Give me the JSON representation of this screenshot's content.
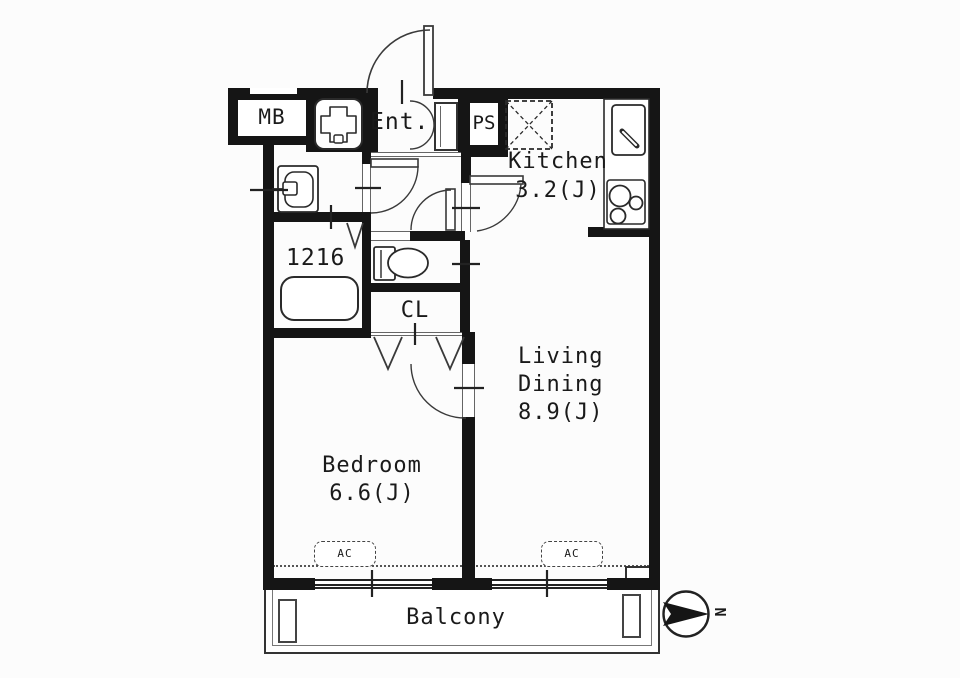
{
  "plan": {
    "meter_box_label": "MB",
    "entrance_label": "Ent.",
    "pipe_space_label": "PS",
    "kitchen_name": "Kitchen",
    "kitchen_size": "3.2(J)",
    "bath_size_label": "1216",
    "closet_label": "CL",
    "living_name_line1": "Living",
    "living_name_line2": "Dining",
    "living_size": "8.9(J)",
    "bedroom_name": "Bedroom",
    "bedroom_size": "6.6(J)",
    "ac_label": "AC",
    "balcony_label": "Balcony",
    "north_label": "N"
  },
  "colors": {
    "wall": "#151515",
    "line": "#3a3a3a",
    "text": "#1a1a1a",
    "background": "#fcfcfc"
  }
}
